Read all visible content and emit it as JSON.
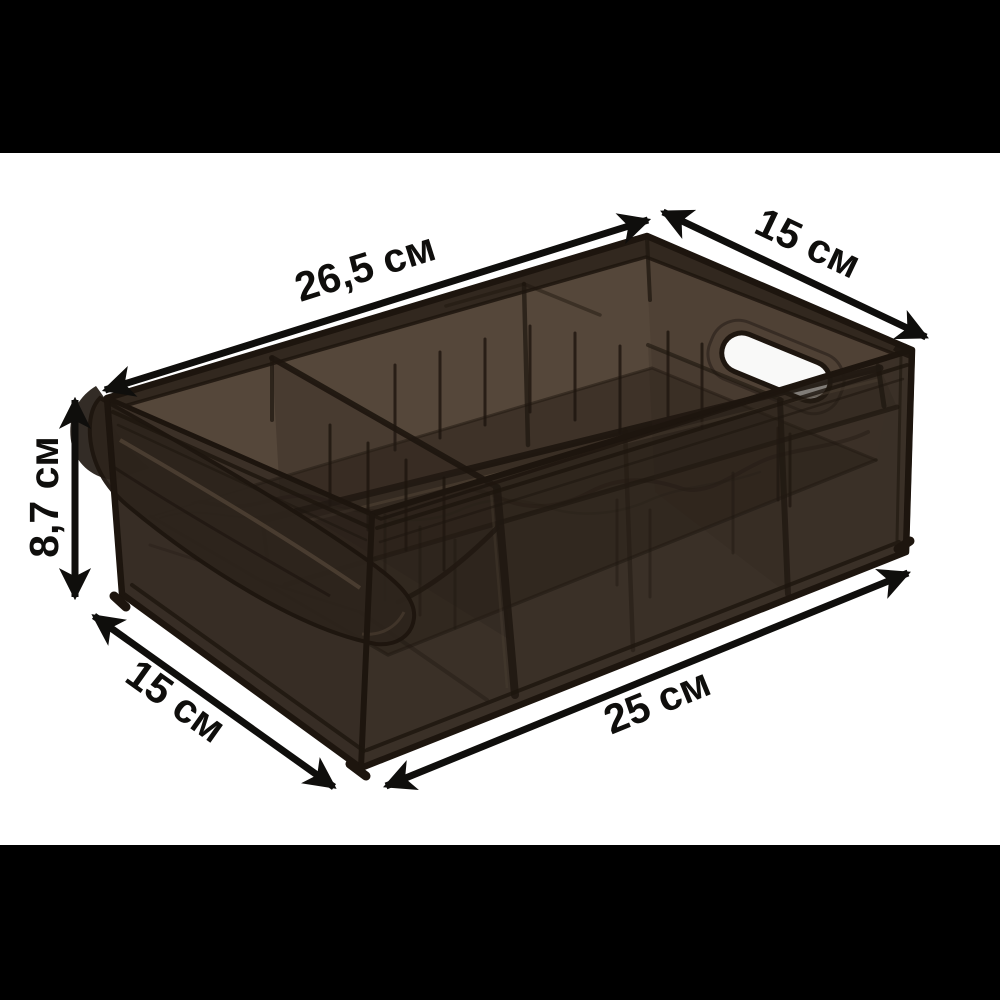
{
  "photo": {
    "description": "Translucent dark smoky-brown plastic storage organizer bin with inner dividers, slot ribs, side handle cutout and front scoop handle, shown in three-quarter view on a white background between black letterbox bars, annotated with dimension arrows",
    "palette": {
      "bars": "#000000",
      "bg": "#ffffff",
      "ink": "#0f0e0c",
      "p_base": "#45392e",
      "p_light": "#5d4e3f",
      "p_mid": "#3a2f25",
      "p_dark": "#2b2219",
      "p_deep": "#241c15",
      "p_edge": "#1d150e",
      "hole": "#ffffff"
    },
    "annotations": {
      "top_length": "26,5 см",
      "top_width": "15 см",
      "side_height": "8,7 см",
      "bottom_width": "15 см",
      "bottom_length": "25 см"
    }
  }
}
